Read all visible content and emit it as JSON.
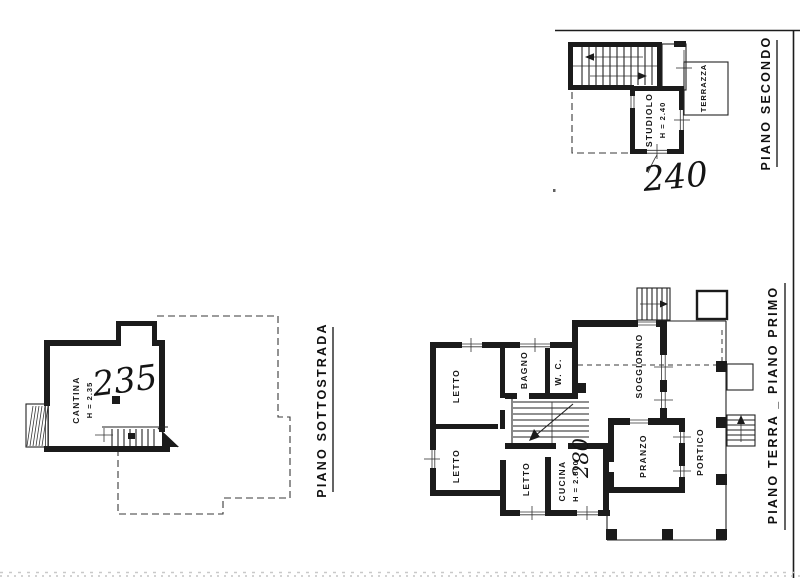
{
  "sheet": {
    "paper_color": "#ffffff",
    "ink_color": "#1b1b1b"
  },
  "titles": {
    "piano_secondo": "PIANO SECONDO",
    "piano_sottostrada": "PIANO SOTTOSTRADA",
    "piano_terra_primo": "PIANO TERRA _ PIANO PRIMO"
  },
  "rooms": {
    "studiolo": {
      "name": "STUDIOLO",
      "height": "H = 2.40"
    },
    "terrazza": {
      "name": "TERRAZZA"
    },
    "cantina": {
      "name": "CANTINA",
      "height": "H = 2.35"
    },
    "letto_nw": {
      "name": "LETTO"
    },
    "bagno": {
      "name": "BAGNO"
    },
    "wc": {
      "name": "W. C."
    },
    "soggiorno": {
      "name": "SOGGIORNO"
    },
    "letto_sw": {
      "name": "LETTO"
    },
    "letto_s": {
      "name": "LETTO"
    },
    "cucina": {
      "name": "CUCINA",
      "height": "H = 2.800"
    },
    "pranzo": {
      "name": "PRANZO"
    },
    "portico": {
      "name": "PORTICO"
    }
  },
  "handwritten": {
    "piano_secondo_height": "240",
    "cantina_height": "235",
    "cucina_height": "280"
  }
}
